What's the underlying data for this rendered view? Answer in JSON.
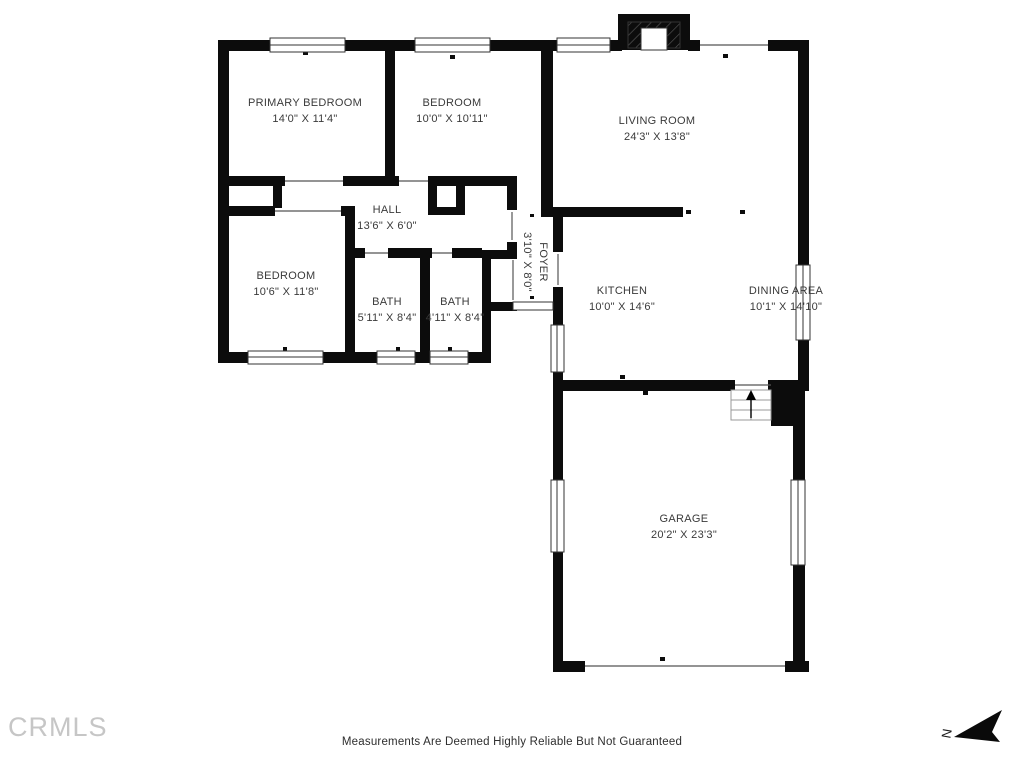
{
  "rooms": [
    {
      "id": "primary-bedroom",
      "name": "PRIMARY BEDROOM",
      "dims": "14'0\" X 11'4\""
    },
    {
      "id": "bedroom-2",
      "name": "BEDROOM",
      "dims": "10'0\" X 10'11\""
    },
    {
      "id": "living-room",
      "name": "LIVING ROOM",
      "dims": "24'3\" X 13'8\""
    },
    {
      "id": "hall",
      "name": "HALL",
      "dims": "13'6\" X 6'0\""
    },
    {
      "id": "foyer",
      "name": "FOYER",
      "dims": "3'10\" X 8'0\""
    },
    {
      "id": "bedroom-3",
      "name": "BEDROOM",
      "dims": "10'6\" X 11'8\""
    },
    {
      "id": "bath-1",
      "name": "BATH",
      "dims": "5'11\" X 8'4\""
    },
    {
      "id": "bath-2",
      "name": "BATH",
      "dims": "4'11\" X 8'4\""
    },
    {
      "id": "kitchen",
      "name": "KITCHEN",
      "dims": "10'0\" X 14'6\""
    },
    {
      "id": "dining-area",
      "name": "DINING AREA",
      "dims": "10'1\" X 14'10\""
    },
    {
      "id": "garage",
      "name": "GARAGE",
      "dims": "20'2\" X 23'3\""
    }
  ],
  "footer": {
    "disclaimer": "Measurements Are Deemed Highly Reliable But Not Guaranteed",
    "watermark": "CRMLS",
    "north_label": "N"
  },
  "colors": {
    "wall": "#0c0c0c",
    "room_text": "#3a3a3a",
    "watermark_gray": "#c6c6c6",
    "background": "#ffffff"
  }
}
